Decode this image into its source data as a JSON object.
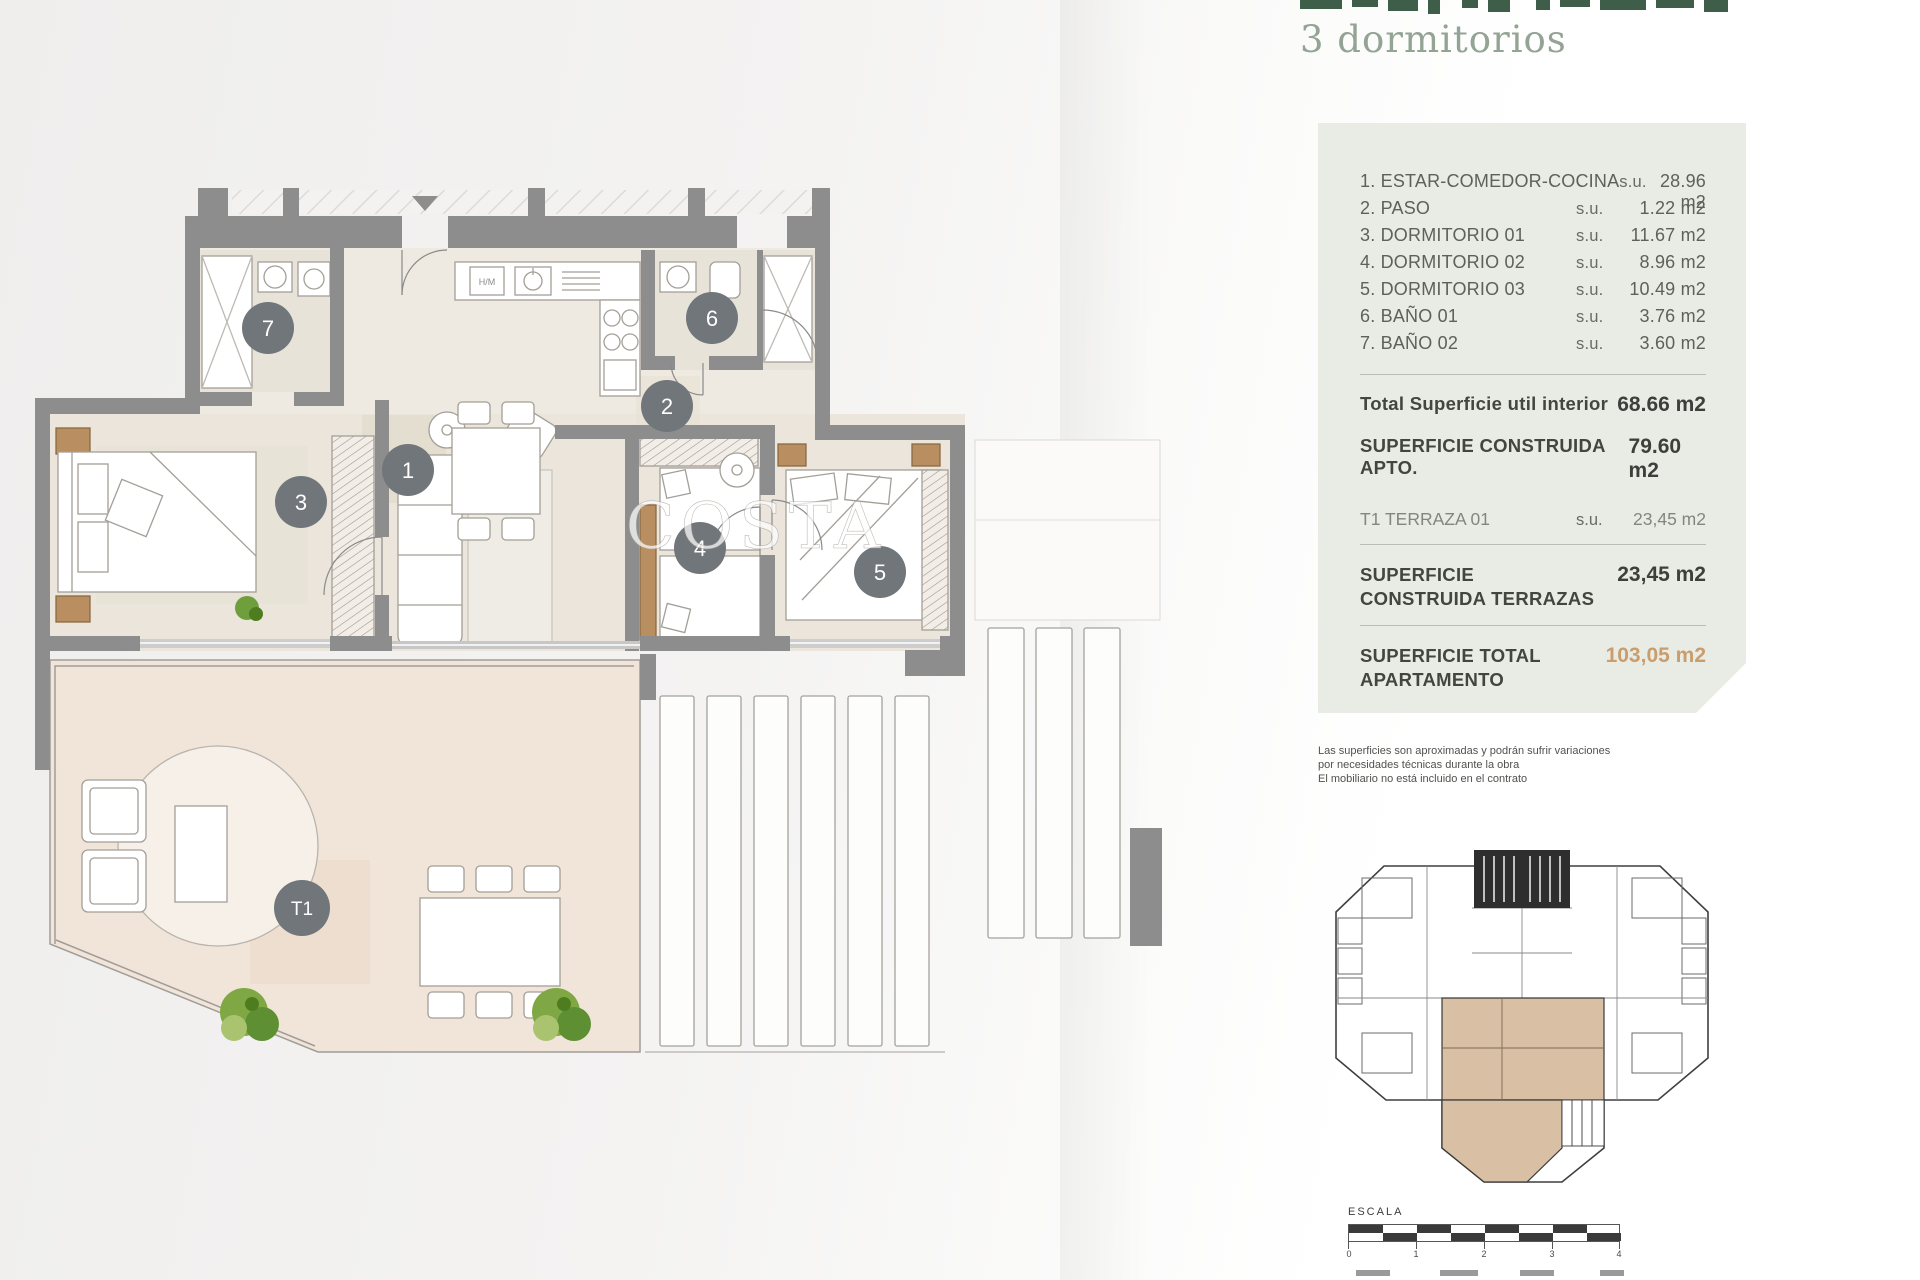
{
  "header": {
    "subtitle": "3 dormitorios"
  },
  "panel": {
    "rooms": [
      {
        "name": "1. ESTAR-COMEDOR-COCINA",
        "unit": "s.u.",
        "value": "28.96 m2"
      },
      {
        "name": "2. PASO",
        "unit": "s.u.",
        "value": "1.22 m2"
      },
      {
        "name": "3. DORMITORIO 01",
        "unit": "s.u.",
        "value": "11.67 m2"
      },
      {
        "name": "4. DORMITORIO 02",
        "unit": "s.u.",
        "value": "8.96 m2"
      },
      {
        "name": "5. DORMITORIO 03",
        "unit": "s.u.",
        "value": "10.49 m2"
      },
      {
        "name": "6. BAÑO 01",
        "unit": "s.u.",
        "value": "3.76 m2"
      },
      {
        "name": "7. BAÑO 02",
        "unit": "s.u.",
        "value": "3.60 m2"
      }
    ],
    "total_util": {
      "label": "Total Superficie util interior",
      "value": "68.66 m2"
    },
    "construida_apto": {
      "label": "SUPERFICIE CONSTRUIDA APTO.",
      "value": "79.60 m2"
    },
    "terraza": {
      "label": "T1 TERRAZA 01",
      "unit": "s.u.",
      "value": "23,45 m2"
    },
    "construida_terrazas": {
      "label": "SUPERFICIE CONSTRUIDA TERRAZAS",
      "value": "23,45 m2"
    },
    "total_apartamento": {
      "label": "SUPERFICIE TOTAL APARTAMENTO",
      "value": "103,05 m2"
    }
  },
  "disclaimer": {
    "line1": "Las superficies son aproximadas y podrán sufrir variaciones",
    "line2": "por necesidades técnicas durante la obra",
    "line3": "El mobiliario no está incluido en el contrato"
  },
  "plan": {
    "watermark": "COSTA",
    "kitchen_appliance_label": "H/M",
    "badges": [
      {
        "label": "1"
      },
      {
        "label": "2"
      },
      {
        "label": "3"
      },
      {
        "label": "4"
      },
      {
        "label": "5"
      },
      {
        "label": "6"
      },
      {
        "label": "7"
      },
      {
        "label": "T1"
      }
    ]
  },
  "escala": {
    "label": "ESCALA",
    "ticks": [
      "0",
      "1",
      "2",
      "3",
      "4"
    ]
  },
  "colors": {
    "accent_total": "#c99d6e",
    "wall_gray": "#8d8d8d",
    "badge_gray": "#70767a",
    "panel_bg": "#e9ece4",
    "title_green": "#3f5e49",
    "subtitle_green": "#93a394",
    "keyplan_highlight": "#d9bfa3"
  }
}
